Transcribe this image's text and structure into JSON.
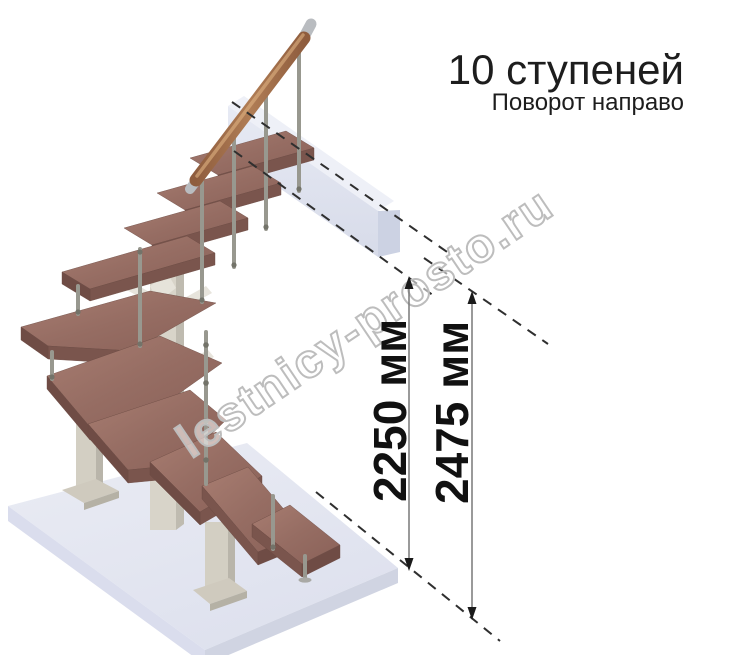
{
  "header": {
    "title": "10 ступеней",
    "subtitle": "Поворот направо"
  },
  "dimensions": {
    "labels": [
      "2250 мм",
      "2475 мм"
    ]
  },
  "watermark": {
    "text": "lestnicy-prosto.ru"
  },
  "stair": {
    "steps_total": 10,
    "turn_direction": "направо",
    "colors": {
      "tread_top": "#9b7168",
      "tread_edge": "#7a554d",
      "handrail_wood": "#9e6b4c",
      "metal_baluster": "#98988f",
      "support_column": "#d8d4c9",
      "floor_slab": "#e3e5ef",
      "landing_slab": "#dfe3ef",
      "dimension_line": "#787878",
      "text": "#1a1a1a"
    }
  }
}
